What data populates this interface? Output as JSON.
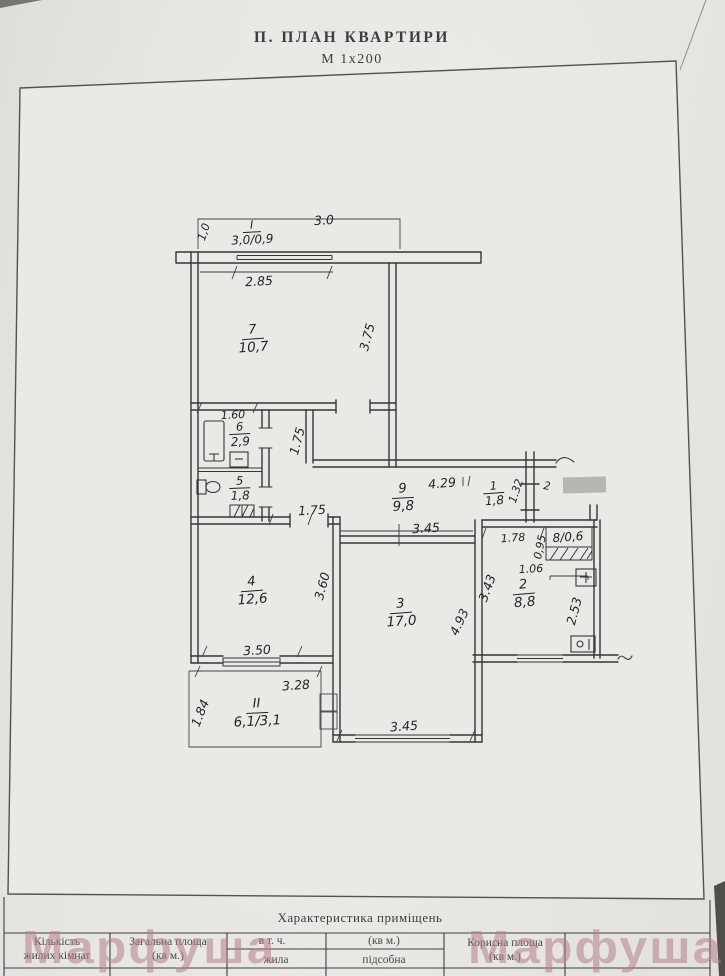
{
  "header": {
    "title": "П. ПЛАН  КВАРТИРИ",
    "scale": "М 1х200"
  },
  "watermark": {
    "text": "Марфуша"
  },
  "plan": {
    "rooms": {
      "balcony1": {
        "num": "I",
        "area": "3,0/0,9"
      },
      "r7": {
        "num": "7",
        "area": "10,7"
      },
      "r6": {
        "num": "6",
        "area": "2,9"
      },
      "r5": {
        "num": "5",
        "area": "1,8"
      },
      "r9": {
        "num": "9",
        "area": "9,8"
      },
      "r1": {
        "num": "1",
        "area": "1,8"
      },
      "r8": {
        "label": "8/0,6"
      },
      "r2": {
        "num": "2",
        "area": "8,8"
      },
      "r3": {
        "num": "3",
        "area": "17,0"
      },
      "r4": {
        "num": "4",
        "area": "12,6"
      },
      "balcony2": {
        "num": "II",
        "area": "6,1/3,1"
      }
    },
    "dims": {
      "d30": "3.0",
      "d10": "1,0",
      "d285": "2.85",
      "d375": "3.75",
      "d160": "1.60",
      "d175v": "1.75",
      "d175h": "1.75",
      "d429": "4.29",
      "d132": "1.32",
      "d2": "2",
      "d178": "1.78",
      "d095": "0,95",
      "d106": "1.06",
      "d343": "3.43",
      "d253": "2.53",
      "d345t": "3.45",
      "d493": "4.93",
      "d345b": "3.45",
      "d360": "3.60",
      "d350": "3.50",
      "d328": "3.28",
      "d184": "1.84"
    }
  },
  "table": {
    "caption": "Характеристика приміщень",
    "col1": [
      "Кількість",
      "жилих кімнат"
    ],
    "col2": [
      "Загальна площа",
      "(кв м.)"
    ],
    "col34_top": [
      "в т. ч.",
      "(кв м.)"
    ],
    "col3_sub": "жила",
    "col4_sub": "підсобна",
    "col5": [
      "Корисна площа",
      "(кв м.)"
    ]
  }
}
